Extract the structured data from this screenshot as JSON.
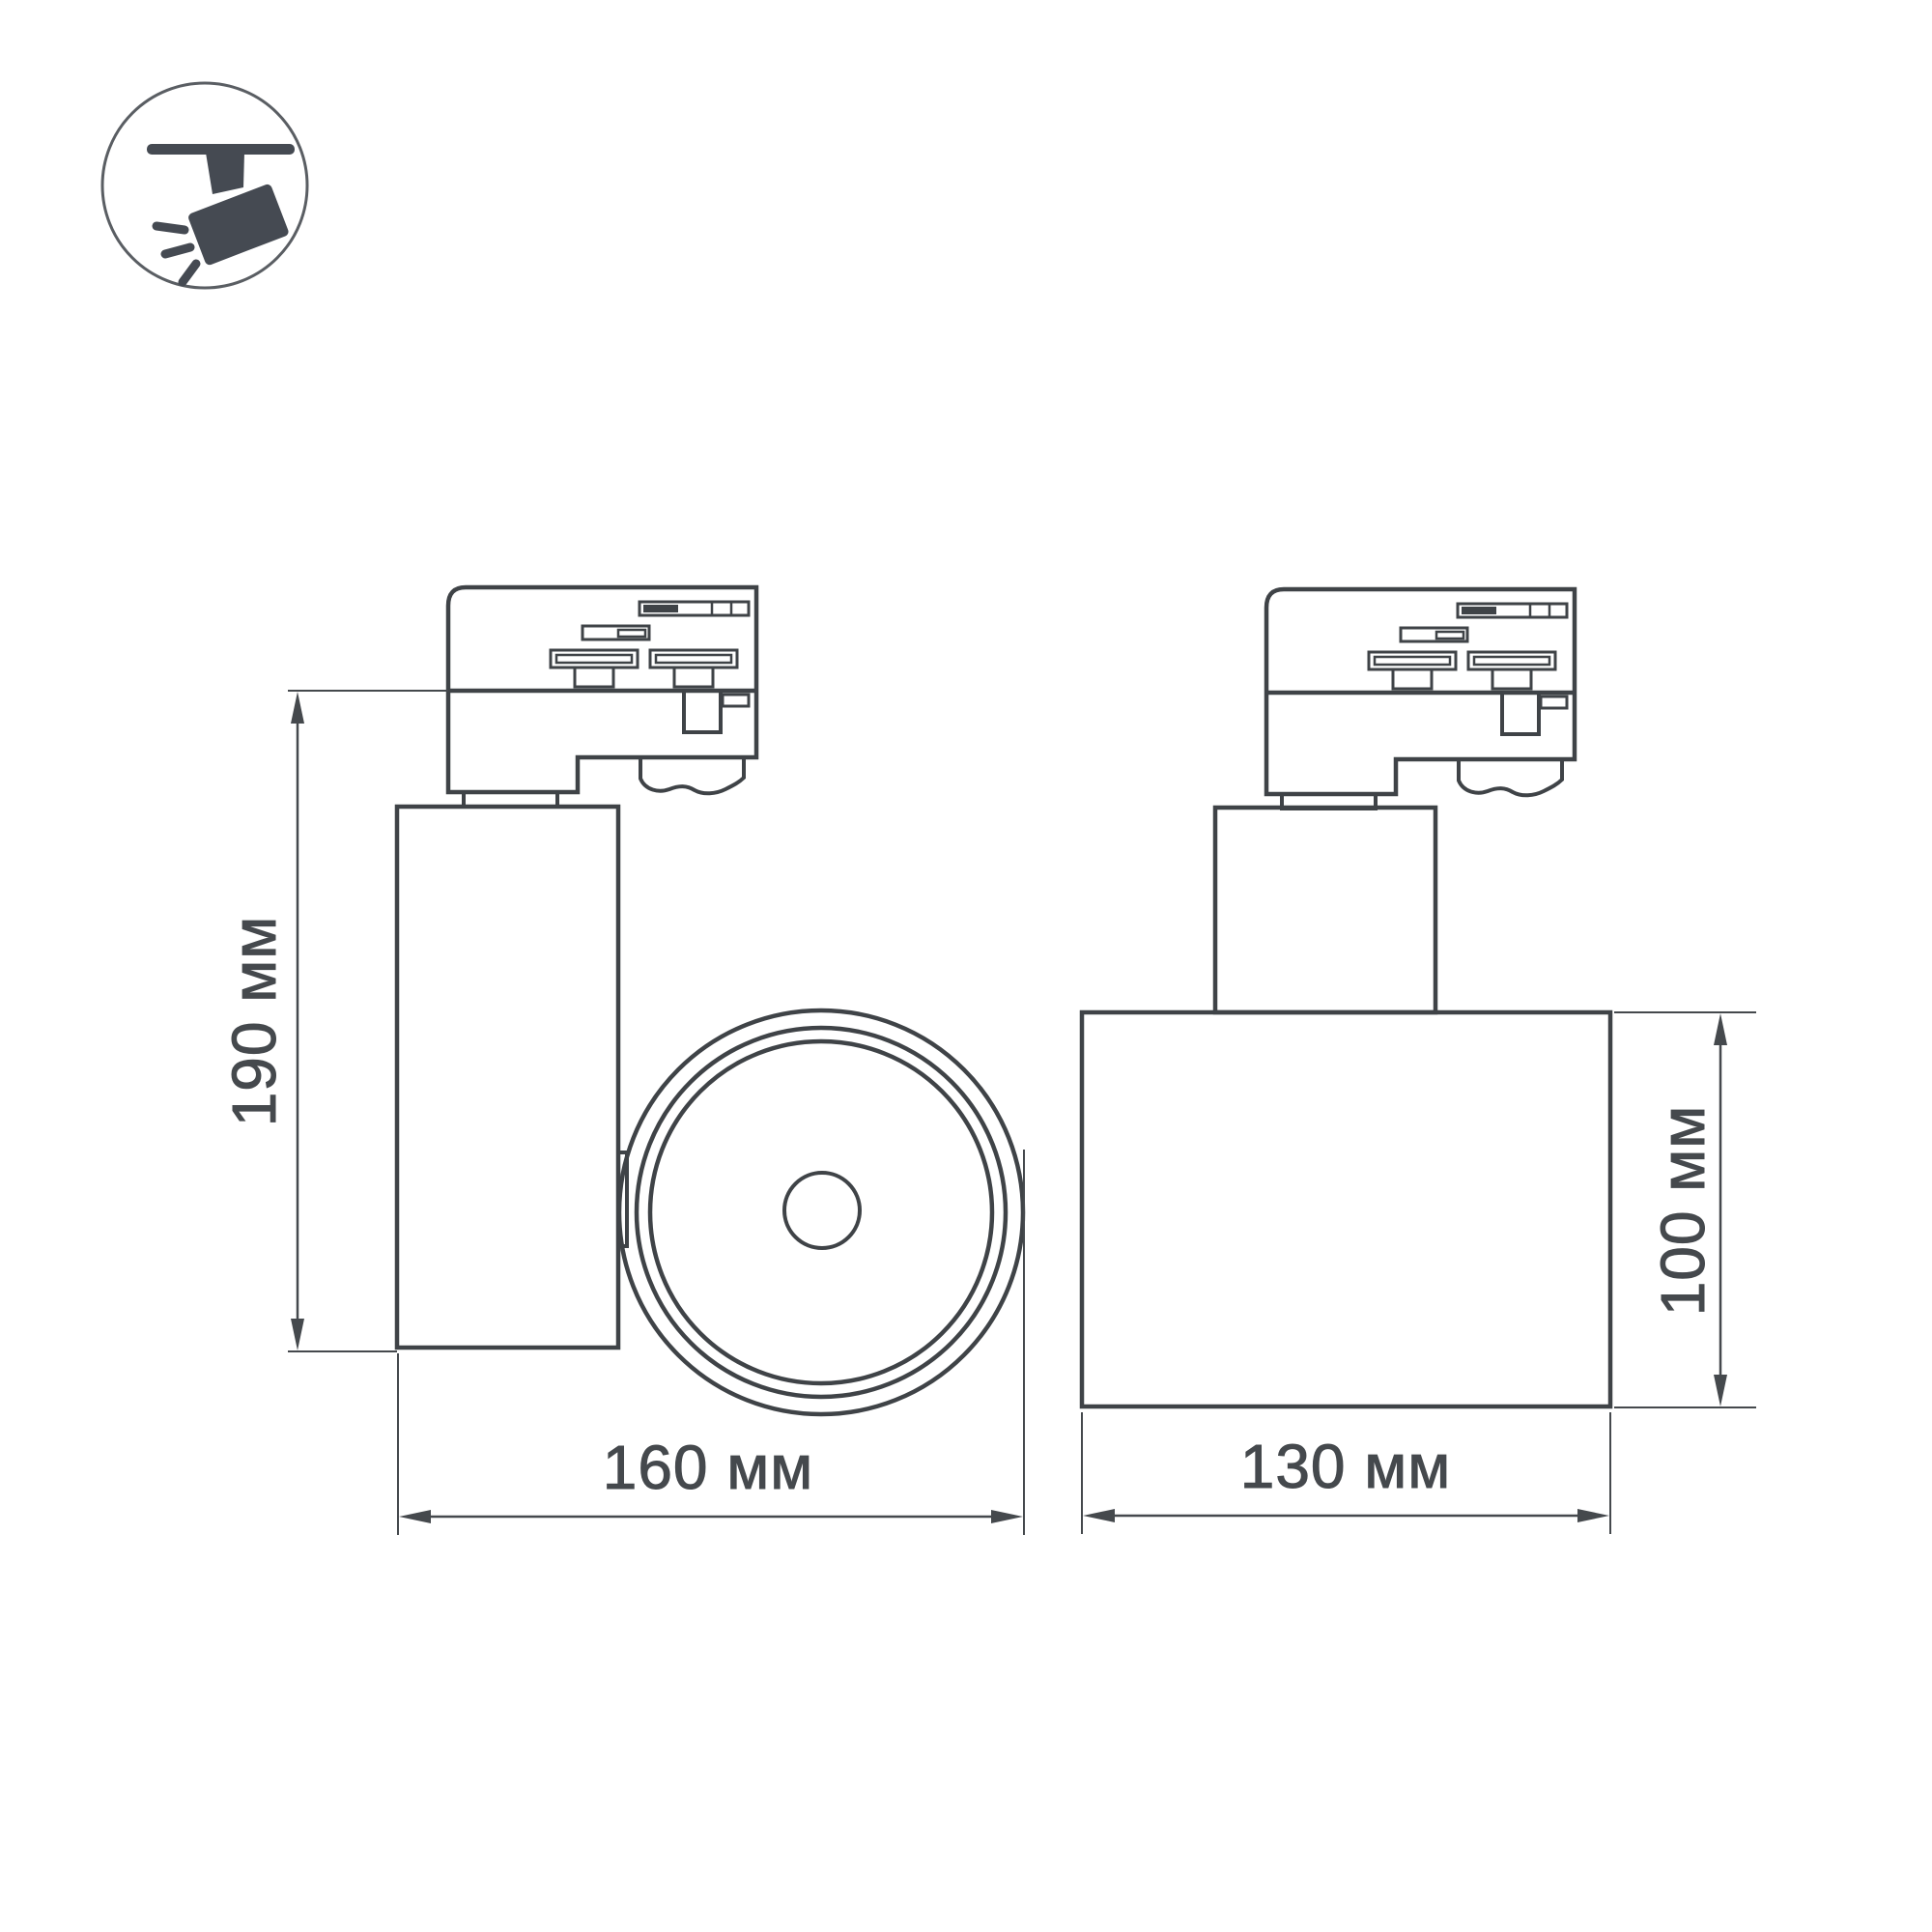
{
  "page": {
    "background": "#ffffff"
  },
  "icon": {
    "name": "track-spotlight-icon",
    "color": "#454a52",
    "ring_color": "#5a5e63"
  },
  "drawing": {
    "line_color": "#3f4347",
    "dimension_color": "#45494d",
    "unit": "мм",
    "views": {
      "side": {
        "name": "side-view",
        "height_label": "190 мм",
        "width_label": "160 мм"
      },
      "front": {
        "name": "front-view",
        "height_label": "100 мм",
        "width_label": "130 мм"
      }
    }
  }
}
